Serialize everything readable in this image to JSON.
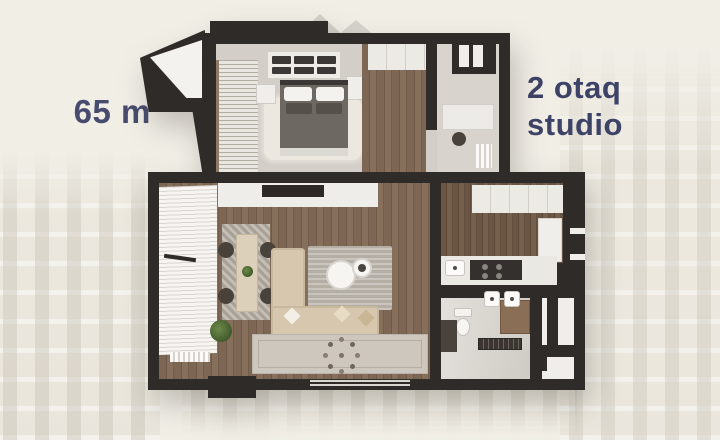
{
  "page": {
    "background_color": "#f1eee6"
  },
  "area_label": {
    "text": "65 m²"
  },
  "type_label": {
    "line1": "2 otaq",
    "line2": "studio"
  },
  "colors": {
    "label_text": "#474c6e",
    "type_text": "#3d4366",
    "walls": "#2f2b29",
    "wood_floor": "#7d6754"
  },
  "floor_plan": {
    "rooms": [
      "balcony",
      "bedroom",
      "hallway",
      "workspace",
      "living-room",
      "kitchen",
      "bathroom"
    ]
  }
}
